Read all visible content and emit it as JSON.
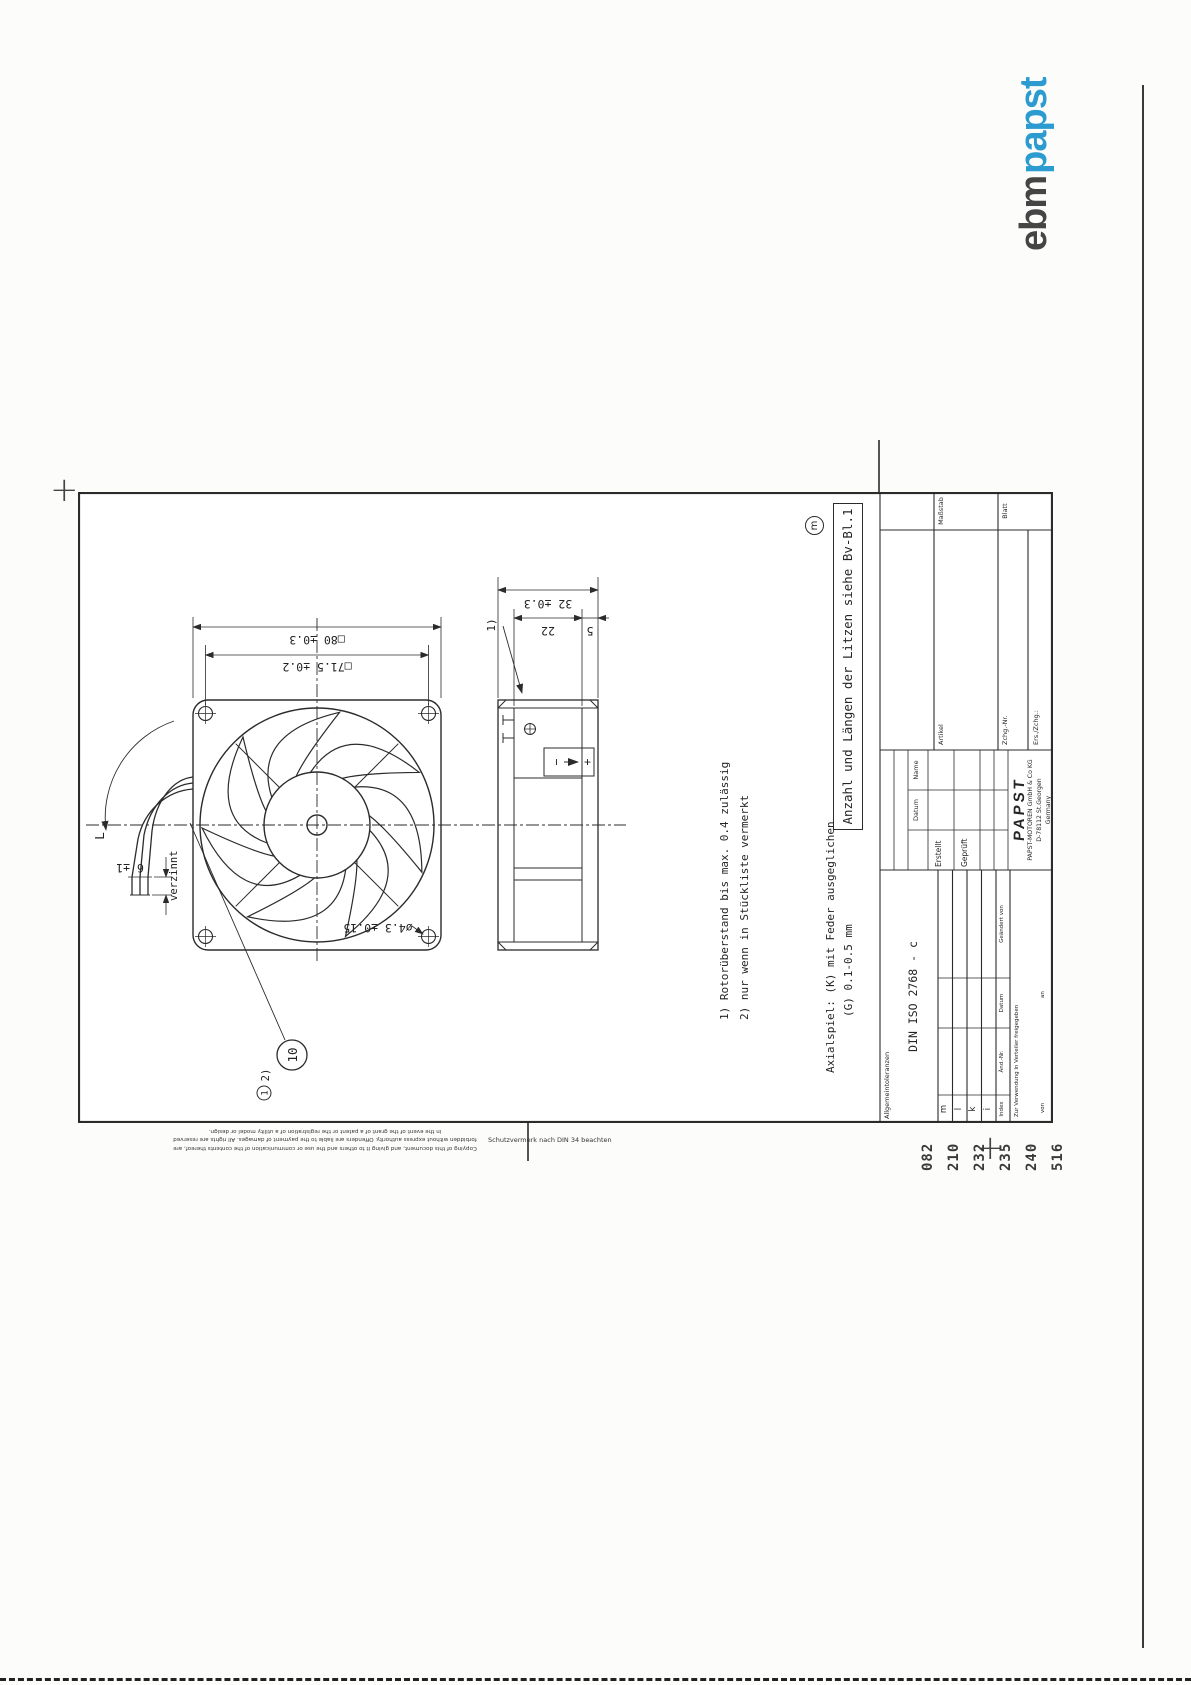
{
  "logo": {
    "ebm": "ebm",
    "papst": "papst",
    "colors": {
      "ebm": "#454545",
      "papst": "#2b9bd0",
      "globe": "#5fa91c"
    }
  },
  "drawing": {
    "dims": {
      "side": "□80 ±0.3",
      "pitch": "□71.5 ±0.2",
      "hole": "ø4.3 ±0.15",
      "depth": "32 ±0.3",
      "mid": "22",
      "flange": "5",
      "lead_length": "L",
      "tinned": "6 ±1",
      "tinned_note": "verzinnt"
    },
    "balloon": "10",
    "circled_one": "1",
    "footnote2_ref": "2)",
    "footnote1_ref": "1)",
    "polarity": {
      "minus": "−",
      "plus": "+"
    },
    "notes": {
      "n1": "1) Rotorüberstand bis max. 0.4 zulässig",
      "n2": "2) nur wenn in Stückliste vermerkt",
      "axial1": "Axialspiel: (K) mit Feder ausgeglichen",
      "axial2": "(G) 0.1-0.5 mm",
      "boxed": "Anzahl und Längen der Litzen siehe Bv-Bl.1",
      "rev_mark": "m"
    }
  },
  "titleblock": {
    "allgemein": "Allgemeintoleranzen",
    "din": "DIN ISO 2768 - c",
    "datum": "Datum",
    "name": "Name",
    "erstellt": "Erstellt",
    "geprueft": "Geprüft",
    "artikel": "Artikel",
    "zchg_nr": "Zchg.-Nr.",
    "ers_zchg": "Ers./Zchg.:",
    "massstab": "Maßstab",
    "blatt": "Blatt",
    "papst": "PAPST",
    "company": "PAPST-MOTOREN GmbH & Co KG",
    "city": "D-78112 St.Georgen",
    "country": "Germany",
    "index_header": {
      "index": "Index",
      "aend_nr": "Änd.-Nr.",
      "datum": "Datum",
      "geaendert": "Geändert von"
    },
    "index_rows": [
      "m",
      "l",
      "k",
      "i"
    ],
    "verteiler": "Zur Verwendung In Verteiler freigegeben",
    "von": "von",
    "an": "an"
  },
  "margin": {
    "codes": [
      "082",
      "210",
      "232",
      "235",
      "240",
      "516"
    ],
    "copyright": [
      "Copying of this document, and giving it to others and the use or communication of the contents thereof, are",
      "forbidden without express authority. Offenders are liable to the payment of damages. All rights are reserved",
      "in the event of the grant of a patent or the registration of a utility model or design."
    ],
    "schutz": "Schutzvermerk nach DIN 34 beachten",
    "reg_mark": "+"
  }
}
